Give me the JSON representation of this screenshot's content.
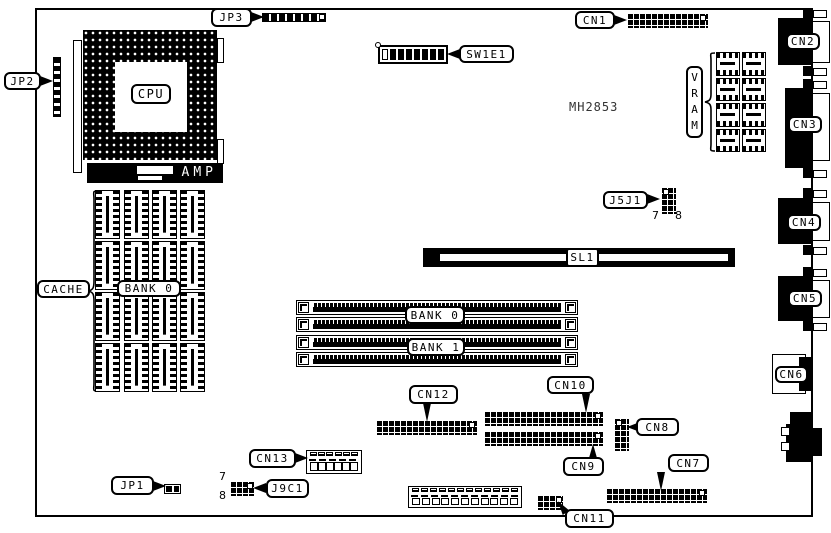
{
  "board": {
    "chip_marking": "MH2853"
  },
  "cpu": {
    "label": "CPU",
    "amp": "AMP"
  },
  "jumpers": {
    "jp1": "JP1",
    "jp2": "JP2",
    "jp3": "JP3"
  },
  "dip_switch": {
    "label": "SW1E1"
  },
  "slot": {
    "sl1": "SL1"
  },
  "memory": {
    "cache": {
      "label": "CACHE",
      "bank": "BANK 0"
    },
    "simm": {
      "bank0": "BANK 0",
      "bank1": "BANK 1"
    },
    "vram": {
      "label": "VRAM"
    }
  },
  "headers": {
    "j5j1": {
      "label": "J5J1",
      "pin_left": "7",
      "pin_right": "8"
    },
    "j9c1": {
      "label": "J9C1",
      "pin_top": "7",
      "pin_bottom": "8"
    }
  },
  "connectors": {
    "cn1": "CN1",
    "cn2": "CN2",
    "cn3": "CN3",
    "cn4": "CN4",
    "cn5": "CN5",
    "cn6": "CN6",
    "cn7": "CN7",
    "cn8": "CN8",
    "cn9": "CN9",
    "cn10": "CN10",
    "cn11": "CN11",
    "cn12": "CN12",
    "cn13": "CN13"
  }
}
